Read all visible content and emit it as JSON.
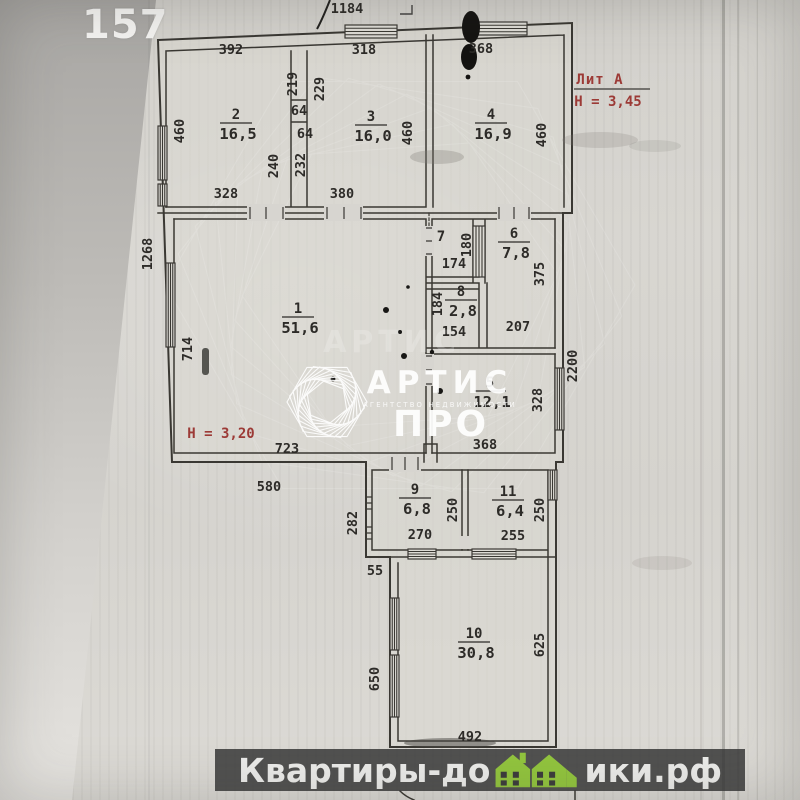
{
  "page": {
    "photo_number": "157"
  },
  "annotations": {
    "lit": "Лит А",
    "h_upper": "Н = 3,45",
    "h_lower": "Н = 3,20"
  },
  "watermark": {
    "brand": "АРТИС",
    "subtitle": "АГЕНТСТВО НЕДВИЖИМОСТИ",
    "brand2": "ПРО",
    "ghost": "АРТИС"
  },
  "footer": {
    "text_left": "Квартиры-до",
    "text_right": "ики.рф",
    "icon": "green-houses-icon"
  },
  "colors": {
    "red": "#9c3a36",
    "green": "#92c53e",
    "ink": "#3a3833",
    "dim_text": "#2d2b28",
    "footer_bg": "rgba(56,56,56,0.85)"
  },
  "plan": {
    "rooms": [
      {
        "n": "1",
        "area": "51,6",
        "x": 298,
        "y": 313
      },
      {
        "n": "2",
        "area": "16,5",
        "x": 236,
        "y": 119
      },
      {
        "n": "3",
        "area": "16,0",
        "x": 371,
        "y": 121
      },
      {
        "n": "4",
        "area": "16,9",
        "x": 491,
        "y": 119
      },
      {
        "n": "5",
        "area": "12,1",
        "x": 490,
        "y": 387
      },
      {
        "n": "6",
        "area": "7,8",
        "x": 514,
        "y": 238
      },
      {
        "n": "7",
        "area": "",
        "x": 441,
        "y": 241
      },
      {
        "n": "8",
        "area": "2,8",
        "x": 461,
        "y": 296
      },
      {
        "n": "9",
        "area": "6,8",
        "x": 415,
        "y": 494
      },
      {
        "n": "10",
        "area": "30,8",
        "x": 474,
        "y": 638
      },
      {
        "n": "11",
        "area": "6,4",
        "x": 508,
        "y": 496
      }
    ],
    "dimensions": [
      {
        "t": "1184",
        "x": 347,
        "y": 13
      },
      {
        "t": "392",
        "x": 231,
        "y": 54
      },
      {
        "t": "318",
        "x": 364,
        "y": 54
      },
      {
        "t": "368",
        "x": 481,
        "y": 53
      },
      {
        "t": "460",
        "x": 184,
        "y": 131,
        "v": 1
      },
      {
        "t": "219",
        "x": 297,
        "y": 84,
        "v": 1
      },
      {
        "t": "229",
        "x": 324,
        "y": 89,
        "v": 1
      },
      {
        "t": "64",
        "x": 299,
        "y": 115
      },
      {
        "t": "64",
        "x": 305,
        "y": 138
      },
      {
        "t": "240",
        "x": 278,
        "y": 166,
        "v": 1
      },
      {
        "t": "232",
        "x": 305,
        "y": 165,
        "v": 1
      },
      {
        "t": "460",
        "x": 412,
        "y": 133,
        "v": 1
      },
      {
        "t": "460",
        "x": 546,
        "y": 135,
        "v": 1
      },
      {
        "t": "328",
        "x": 226,
        "y": 198
      },
      {
        "t": "380",
        "x": 342,
        "y": 198
      },
      {
        "t": "1268",
        "x": 152,
        "y": 254,
        "v": 1
      },
      {
        "t": "714",
        "x": 192,
        "y": 349,
        "v": 1
      },
      {
        "t": "174",
        "x": 454,
        "y": 268
      },
      {
        "t": "180",
        "x": 471,
        "y": 245,
        "v": 1
      },
      {
        "t": "375",
        "x": 544,
        "y": 274,
        "v": 1
      },
      {
        "t": "184",
        "x": 442,
        "y": 304,
        "v": 1
      },
      {
        "t": "154",
        "x": 454,
        "y": 336
      },
      {
        "t": "207",
        "x": 518,
        "y": 331
      },
      {
        "t": "2200",
        "x": 577,
        "y": 366,
        "v": 1
      },
      {
        "t": "328",
        "x": 542,
        "y": 400,
        "v": 1
      },
      {
        "t": "368",
        "x": 485,
        "y": 449
      },
      {
        "t": "723",
        "x": 287,
        "y": 453
      },
      {
        "t": "580",
        "x": 269,
        "y": 491
      },
      {
        "t": "250",
        "x": 457,
        "y": 510,
        "v": 1
      },
      {
        "t": "250",
        "x": 544,
        "y": 510,
        "v": 1
      },
      {
        "t": "282",
        "x": 357,
        "y": 523,
        "v": 1
      },
      {
        "t": "270",
        "x": 420,
        "y": 539
      },
      {
        "t": "255",
        "x": 513,
        "y": 540
      },
      {
        "t": "55",
        "x": 375,
        "y": 575
      },
      {
        "t": "650",
        "x": 379,
        "y": 679,
        "v": 1
      },
      {
        "t": "625",
        "x": 544,
        "y": 645,
        "v": 1
      },
      {
        "t": "492",
        "x": 470,
        "y": 741
      }
    ]
  }
}
